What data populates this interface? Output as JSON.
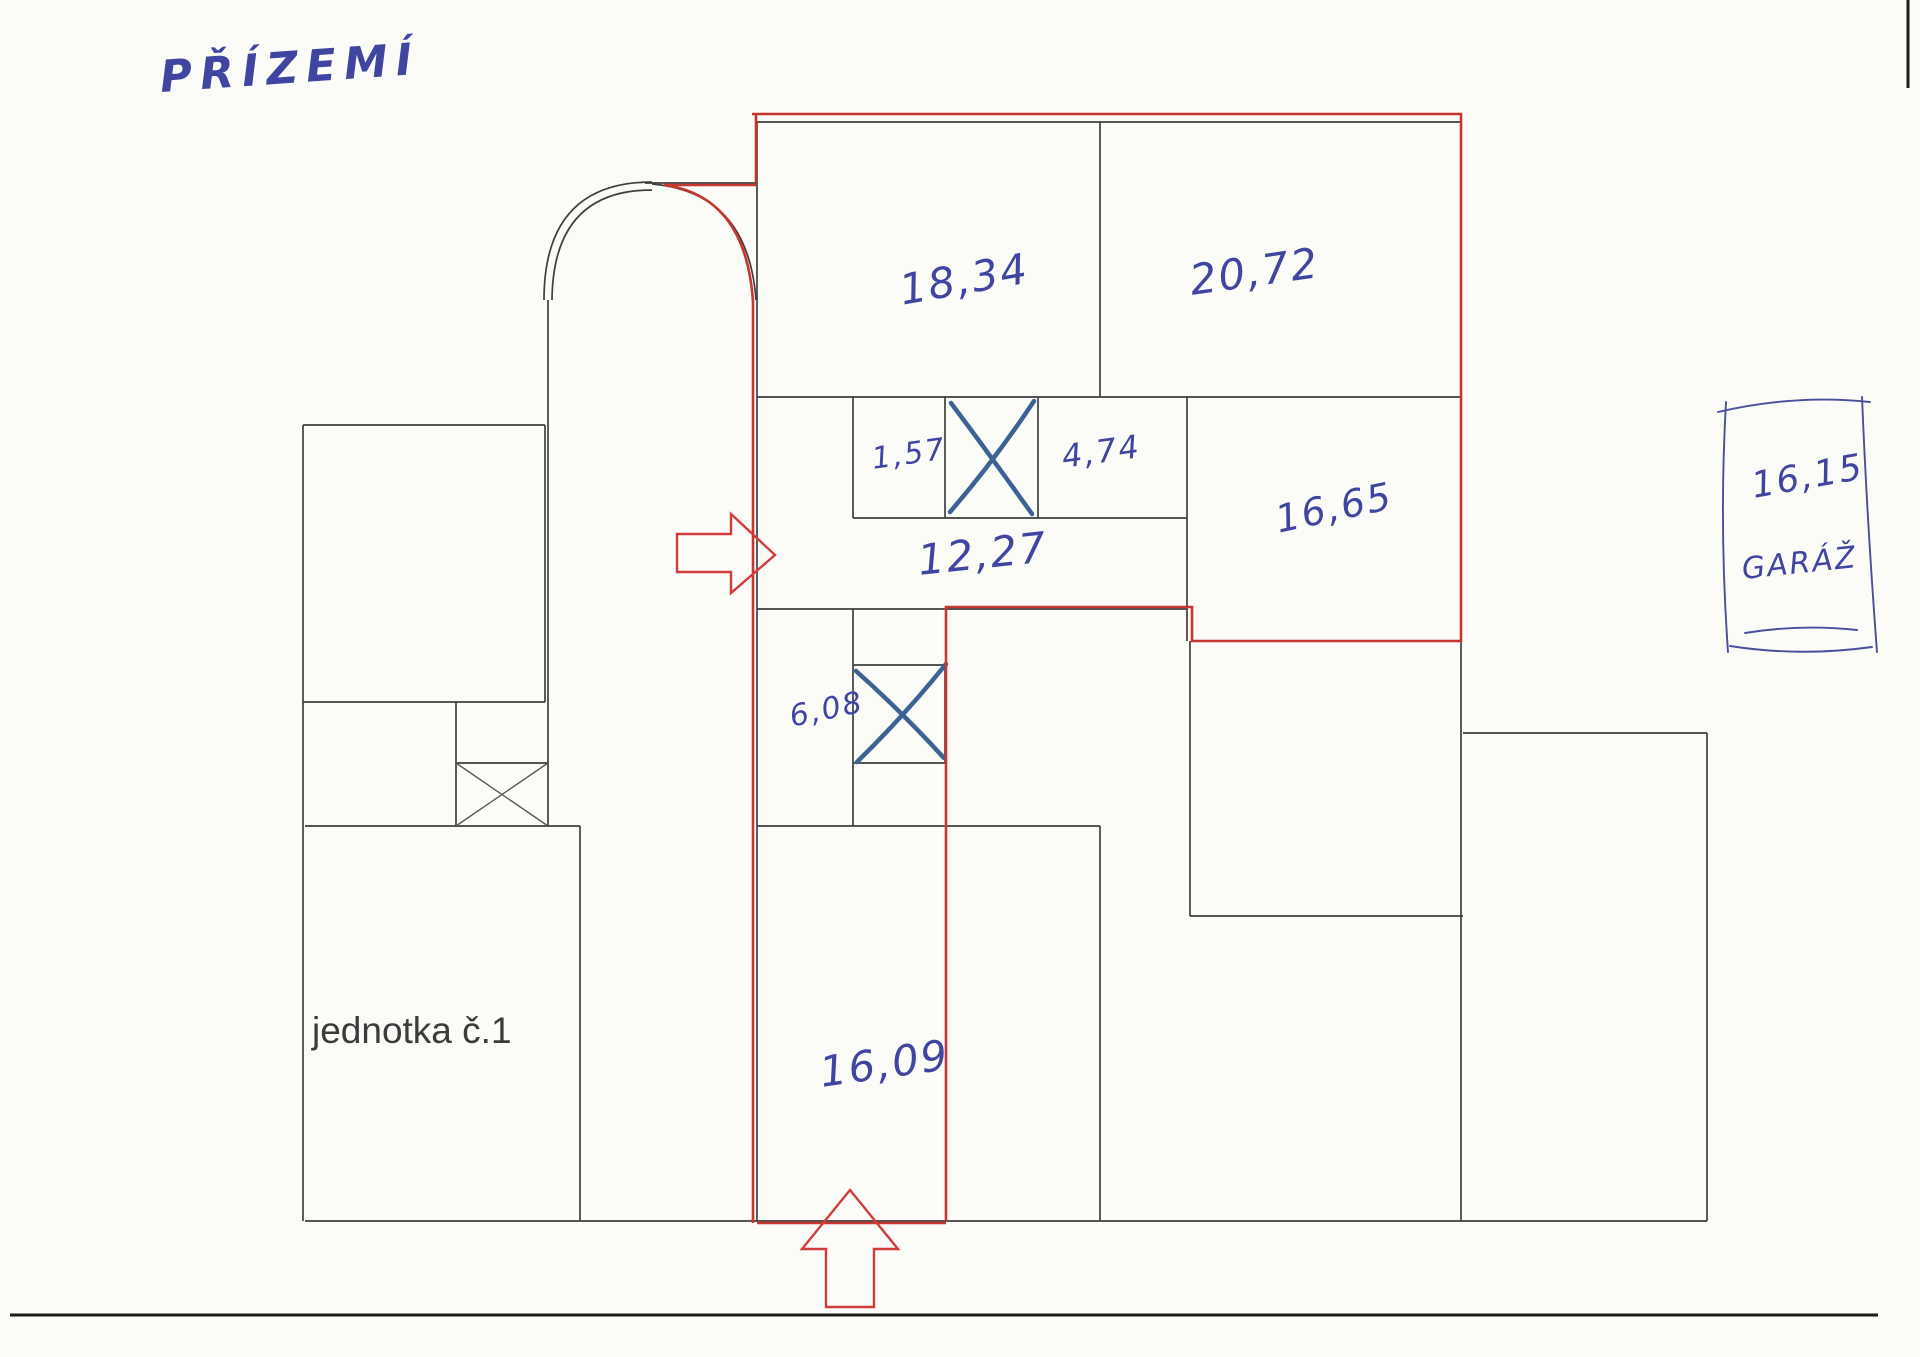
{
  "page": {
    "title": "PŘÍZEMÍ"
  },
  "unit": {
    "label": "jednotka č.1"
  },
  "rooms": {
    "room_18_34": "18,34",
    "room_20_72": "20,72",
    "room_1_57": "1,57",
    "room_4_74": "4,74",
    "room_16_65": "16,65",
    "room_12_27": "12,27",
    "room_6_08": "6,08",
    "room_16_09": "16,09"
  },
  "garage": {
    "area": "16,15",
    "label": "GARÁŽ"
  },
  "colors": {
    "unit_boundary_red": "#c9352f",
    "handwriting_blue": "#4145a2",
    "wall_black": "#3f3f3f",
    "cross_blue": "#3d6394"
  }
}
